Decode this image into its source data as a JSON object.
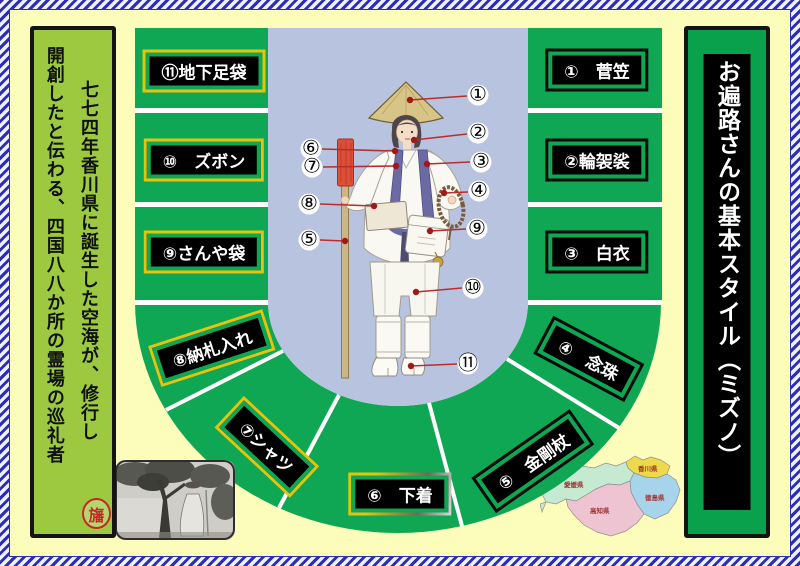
{
  "colors": {
    "page_bg": "#FCFCBB",
    "frame_blue": "#2B2FB5",
    "ring_green": "#0FA753",
    "left_banner_green": "#9CC93F",
    "right_banner_green": "#0AA14D",
    "center_blue": "#B7C3DF",
    "label_border_yellow": "#E3C410",
    "callout_line_red": "#B82E2E"
  },
  "left_banner": {
    "column_right": "七七四年香川県に誕生した空海が、修行し",
    "column_left": "開創したと伝わる、四国八八か所の霊場の巡礼者",
    "stamp": "旛"
  },
  "right_banner": {
    "title": "お遍路さんの基本スタイル（ミズノ）"
  },
  "labels": [
    {
      "text": "①　菅笠"
    },
    {
      "text": "②輪袈裟"
    },
    {
      "text": "③　白衣"
    },
    {
      "text": "④　念珠"
    },
    {
      "text": "⑤　金剛杖"
    },
    {
      "text": "⑥　下着"
    },
    {
      "text": "⑦シャツ"
    },
    {
      "text": "⑧納札入れ"
    },
    {
      "text": "⑨さんや袋"
    },
    {
      "text": "⑩　ズボン"
    },
    {
      "text": "⑪地下足袋"
    }
  ],
  "callouts": [
    "①",
    "②",
    "③",
    "④",
    "⑤",
    "⑥",
    "⑦",
    "⑧",
    "⑨",
    "⑩",
    "⑪"
  ],
  "map": {
    "prefectures": [
      {
        "name": "愛媛県"
      },
      {
        "name": "香川県"
      },
      {
        "name": "徳島県"
      },
      {
        "name": "高知県"
      }
    ]
  }
}
